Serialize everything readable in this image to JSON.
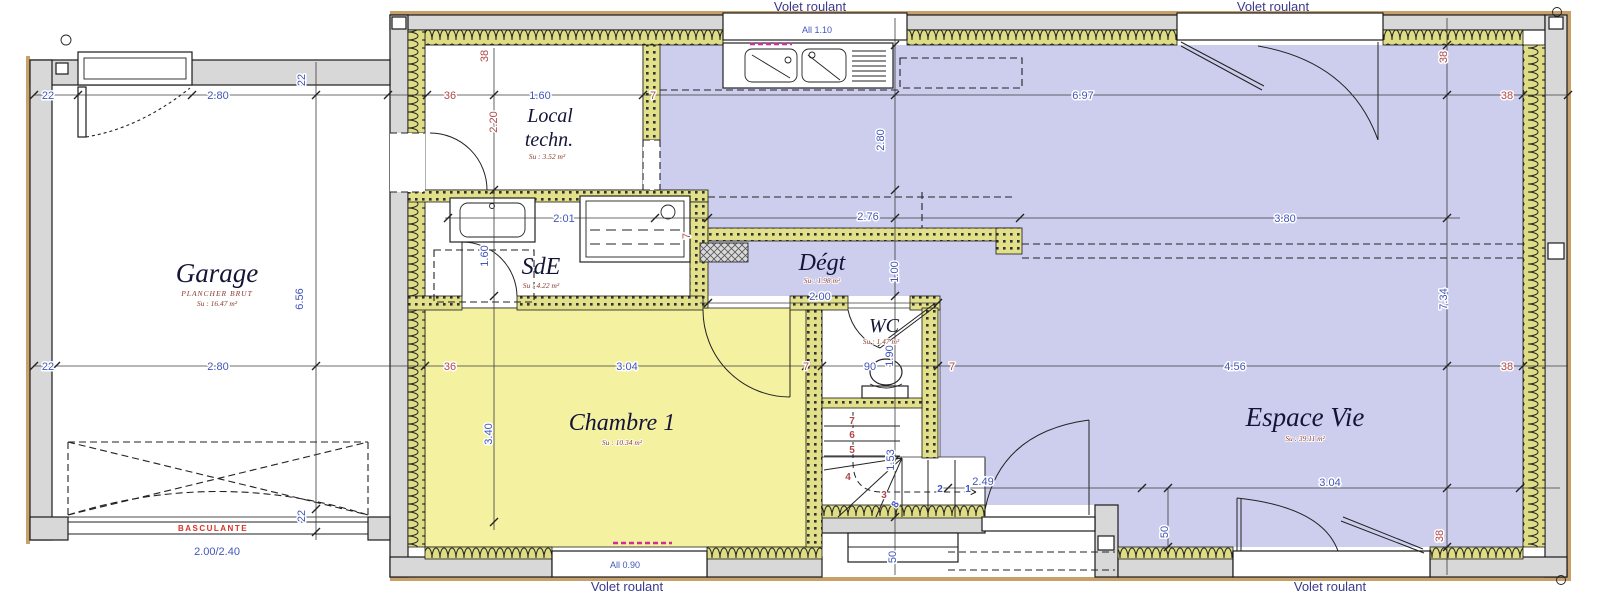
{
  "colors": {
    "floor_living": "#cdcdee",
    "floor_bedroom": "#f4f1a0",
    "insulation": "#dedd85",
    "wall_grey": "#d8d8d8",
    "dim_blue": "#4156bb",
    "dim_red": "#b04848",
    "warning_red": "#d93025",
    "radiator_magenta": "#cc2f9a"
  },
  "labels": {
    "volet": "Volet roulant",
    "all_kitchen": "All 1.10",
    "all_bedroom": "All 0.90",
    "garage_door_type": "BASCULANTE",
    "garage_door_size": "2.00/2.40"
  },
  "rooms": {
    "garage": {
      "name": "Garage",
      "sub1": "PLANCHER BRUT",
      "sub2": "Su : 16.47 m²"
    },
    "local": {
      "name1": "Local",
      "name2": "techn.",
      "sub": "Su : 3.52 m²"
    },
    "sde": {
      "name": "SdE",
      "sub": "Su : 4.22 m²"
    },
    "degt": {
      "name": "Dégt",
      "sub": "Su : 1.98 m²"
    },
    "wc": {
      "name": "WC",
      "sub": "Su : 1.47 m²"
    },
    "chambre": {
      "name": "Chambre 1",
      "sub": "Su : 10.34 m²"
    },
    "espace": {
      "name": "Espace Vie",
      "sub": "Su : 39.11 m²"
    }
  },
  "dims": {
    "d22": "22",
    "d280": "2.80",
    "d36": "36",
    "d160": "1.60",
    "d7": "7",
    "d697": "6.97",
    "d38": "38",
    "d220": "2.20",
    "d201": "2.01",
    "d276": "2.76",
    "d380": "3.80",
    "d734": "7.34",
    "d200": "2.00",
    "d100": "1.00",
    "d304": "3.04",
    "d90": "90",
    "d190": "1.90",
    "d456": "4.56",
    "d656": "6.56",
    "d340": "3.40",
    "d249": "2.49",
    "d153": "1.53",
    "d50": "50"
  },
  "stairs": {
    "s1": "1",
    "s2": "2",
    "s3": "3",
    "s4": "4",
    "s5": "5",
    "s6": "6",
    "s7": "7",
    "s8": "8"
  }
}
